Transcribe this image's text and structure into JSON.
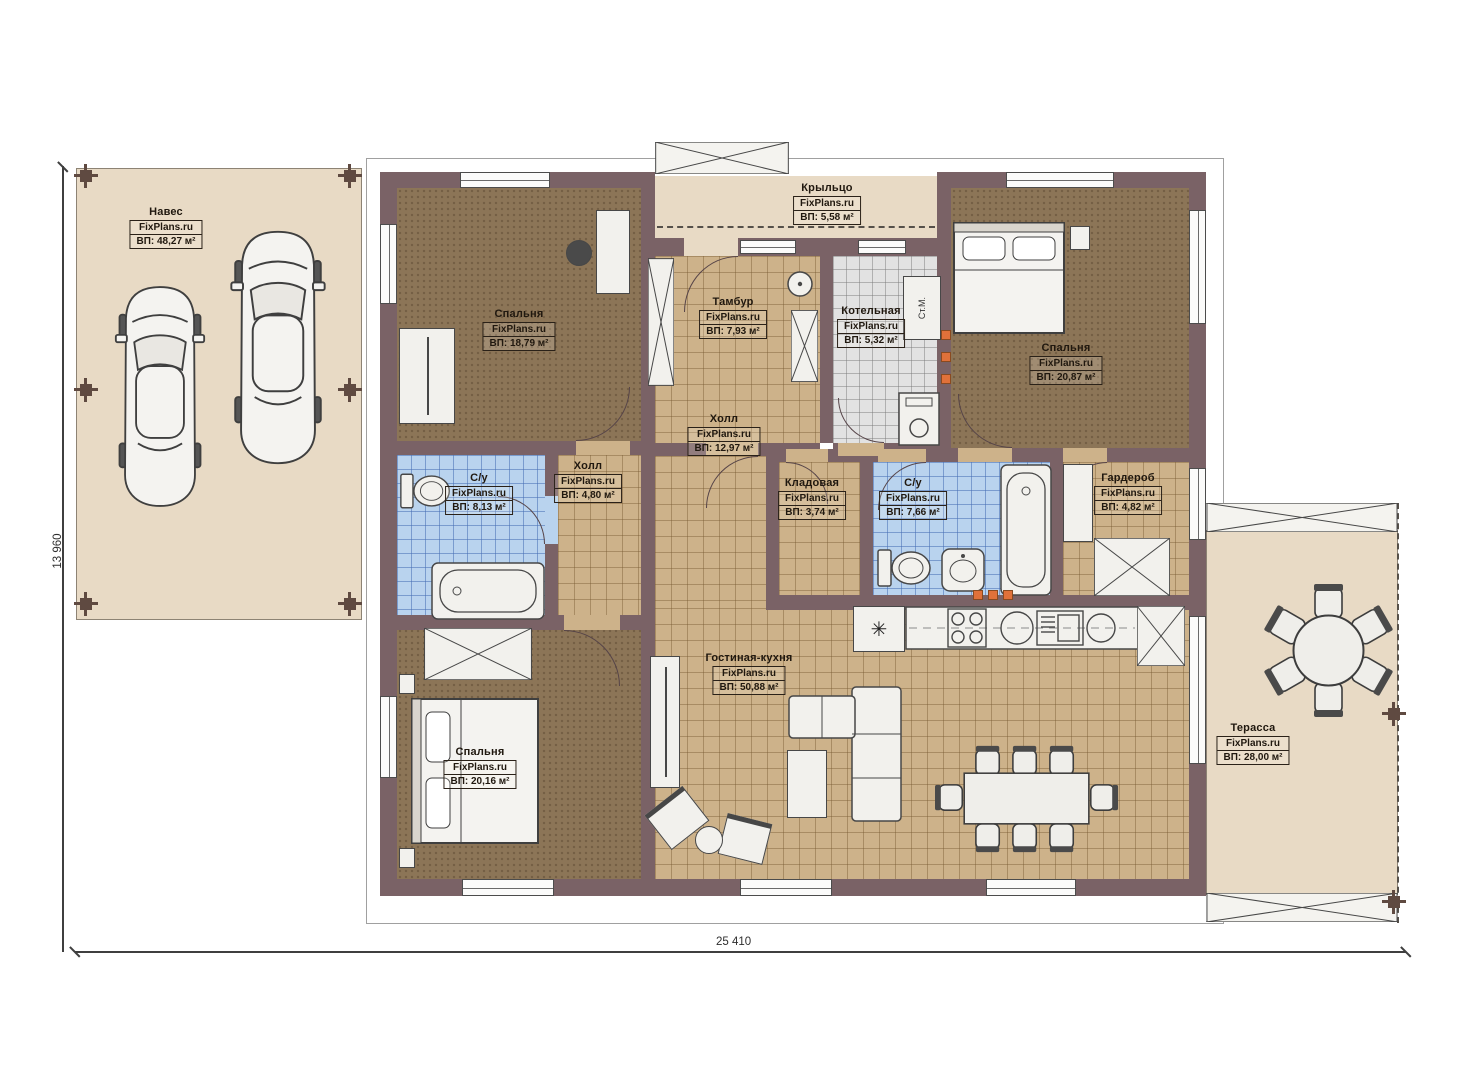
{
  "watermark": "FixPlans.ru",
  "dimensions": {
    "width": "25 410",
    "height": "13 960"
  },
  "appliances": {
    "washing_machine": "Ст.М."
  },
  "icons": {
    "fridge_symbol": "✳"
  },
  "colors": {
    "wall": "#7a6266",
    "bedroom_floor": "#8c7557",
    "tile_tan": "#cdb28a",
    "tile_blue": "#b9d3ee",
    "tile_gray": "#e2e2e2",
    "outdoor": "#e8dac5",
    "accent_orange": "#e0713a"
  },
  "rooms": [
    {
      "name": "Навес",
      "area": "ВП: 48,27 м²"
    },
    {
      "name": "Крыльцо",
      "area": "ВП: 5,58 м²"
    },
    {
      "name": "Спальня",
      "area": "ВП: 18,79 м²"
    },
    {
      "name": "Тамбур",
      "area": "ВП: 7,93 м²"
    },
    {
      "name": "Котельная",
      "area": "ВП: 5,32 м²"
    },
    {
      "name": "Спальня",
      "area": "ВП: 20,87 м²"
    },
    {
      "name": "Холл",
      "area": "ВП: 12,97 м²"
    },
    {
      "name": "Холл",
      "area": "ВП: 4,80 м²"
    },
    {
      "name": "С/у",
      "area": "ВП: 8,13 м²"
    },
    {
      "name": "Кладовая",
      "area": "ВП: 3,74 м²"
    },
    {
      "name": "С/у",
      "area": "ВП: 7,66 м²"
    },
    {
      "name": "Гардероб",
      "area": "ВП: 4,82 м²"
    },
    {
      "name": "Спальня",
      "area": "ВП: 20,16 м²"
    },
    {
      "name": "Гостиная-кухня",
      "area": "ВП: 50,88 м²"
    },
    {
      "name": "Терасса",
      "area": "ВП: 28,00 м²"
    }
  ]
}
